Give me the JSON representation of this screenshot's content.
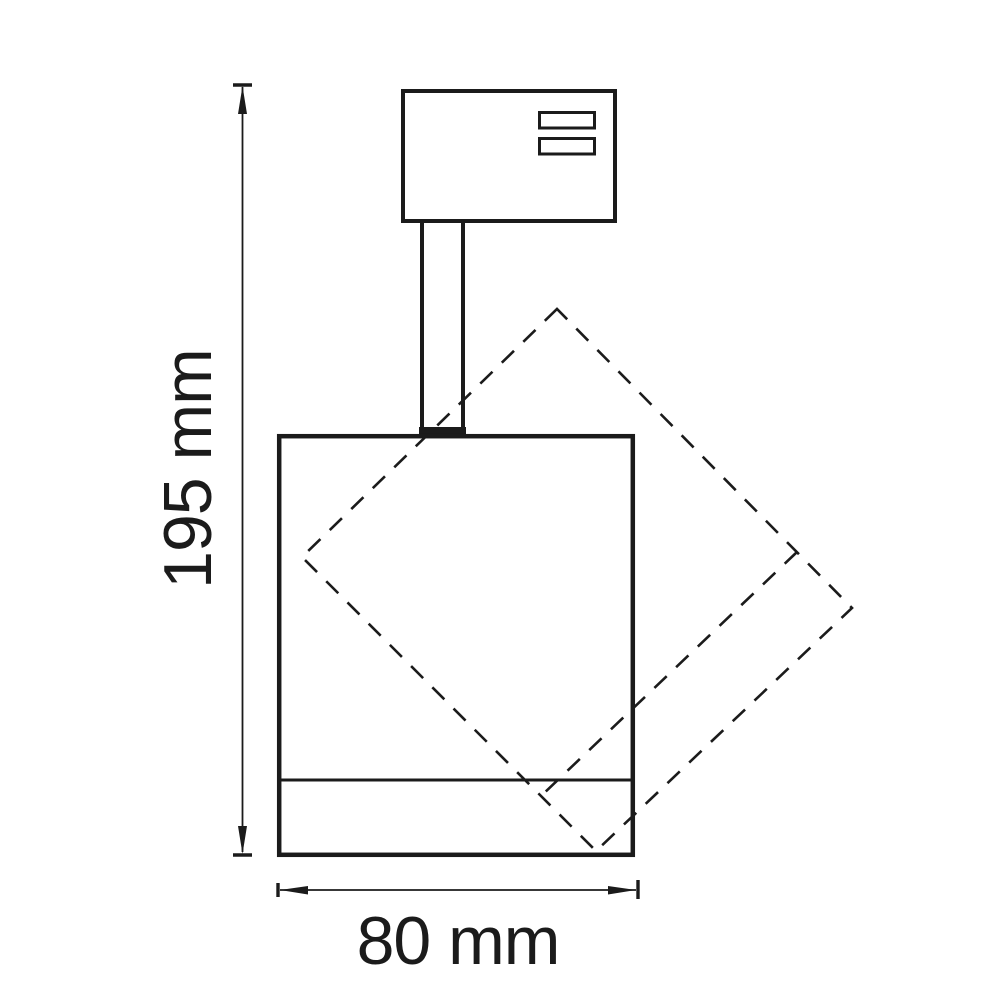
{
  "drawing": {
    "background": "#ffffff",
    "line_color": "#1b1b1b",
    "labels": {
      "height": "195 mm",
      "width": "80 mm"
    }
  }
}
